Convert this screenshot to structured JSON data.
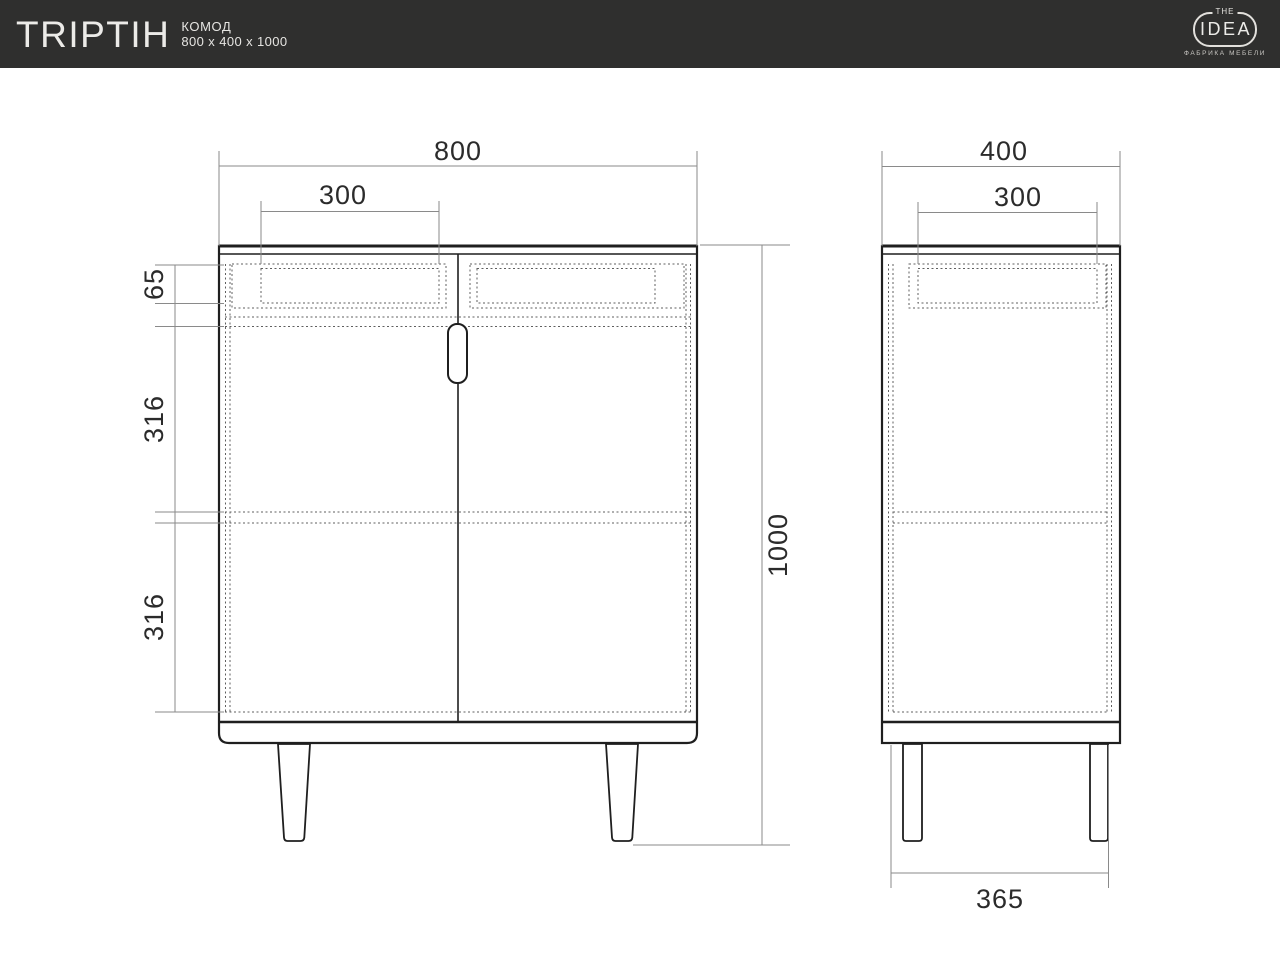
{
  "header": {
    "title": "TRIPTIH",
    "product_type": "КОМОД",
    "product_dimensions": "800 x 400 x 1000",
    "bg_color": "#2f2f2e",
    "logo": {
      "the": "THE",
      "name": "IDEA",
      "tagline": "ФАБРИКА МЕБЕЛИ"
    }
  },
  "drawing": {
    "type": "furniture technical drawing, front and side orthographic views of a dresser",
    "colors": {
      "outline": "#1f1f1f",
      "dimension_lines": "#8a8a8a",
      "hidden_lines": "#5f5f5f",
      "label_text": "#2b2b2b",
      "background": "#ffffff"
    },
    "front_view": {
      "overall_width": "800",
      "drawer_width": "300",
      "drawer_front_height": "65",
      "upper_section_height": "316",
      "lower_section_height": "316",
      "overall_height": "1000"
    },
    "side_view": {
      "overall_depth": "400",
      "drawer_depth": "300",
      "leg_span": "365"
    }
  }
}
